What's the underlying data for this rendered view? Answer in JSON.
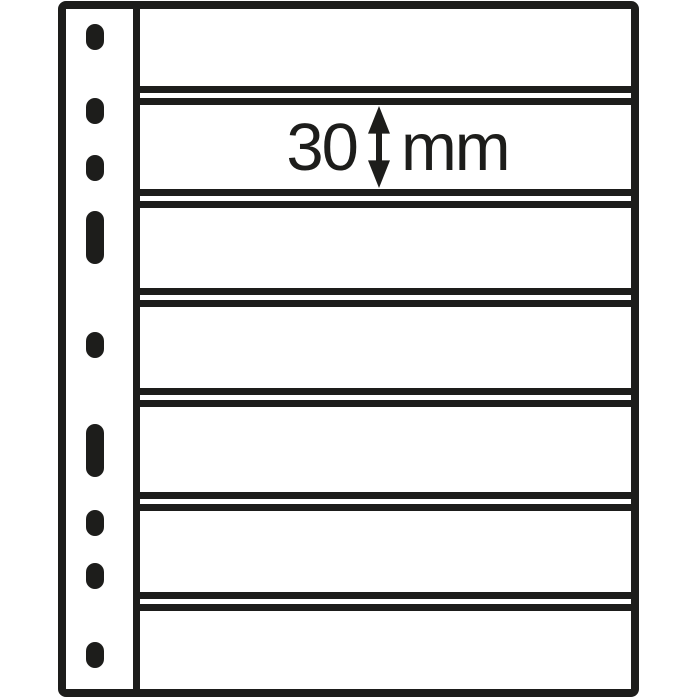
{
  "illustration": {
    "measurement": {
      "value": "30",
      "unit": "mm"
    },
    "pocket_count": 7,
    "punch_hole_count": 9
  },
  "colors": {
    "ink": "#1d1d1b",
    "paper": "#ffffff"
  }
}
